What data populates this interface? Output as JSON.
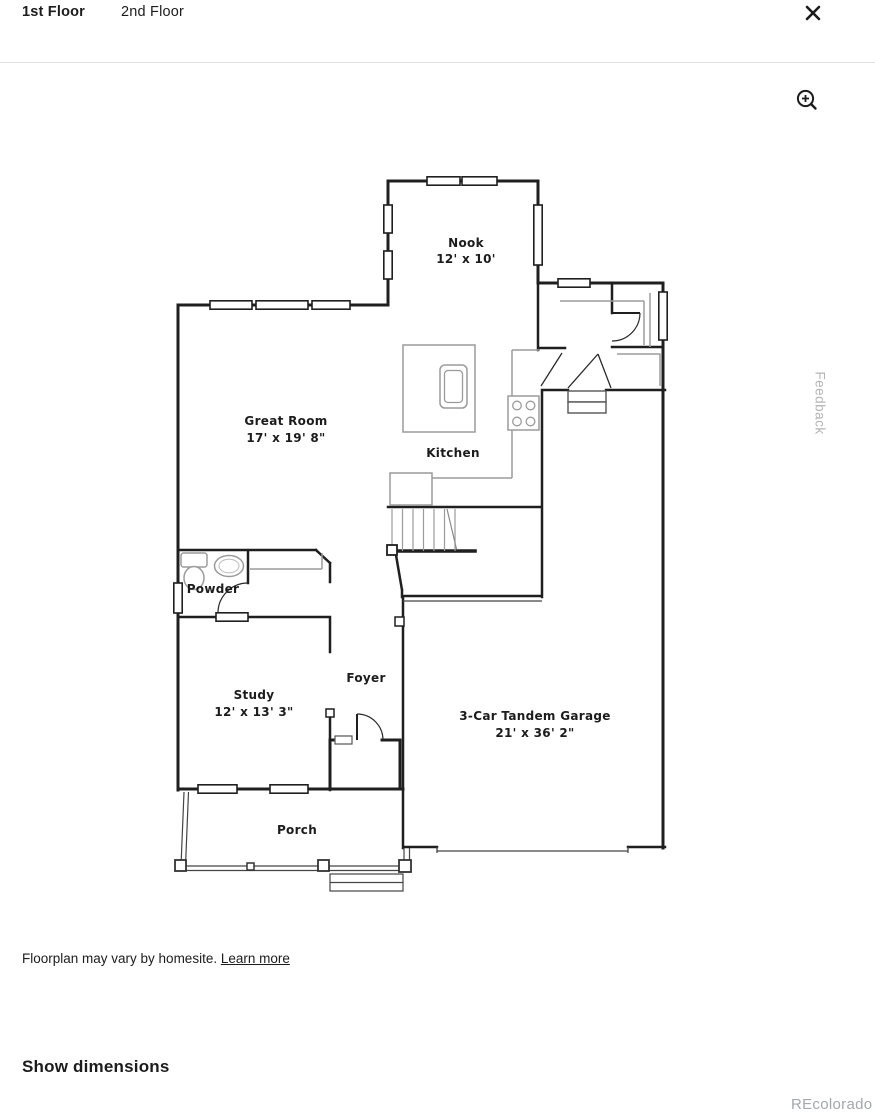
{
  "tabs": [
    {
      "label": "1st Floor",
      "active": true
    },
    {
      "label": "2nd Floor",
      "active": false
    }
  ],
  "controls": {
    "close_icon": "close",
    "zoom_in_icon": "magnifier-plus"
  },
  "floorplan": {
    "rooms": {
      "nook": {
        "name": "Nook",
        "dims": "12' x 10'"
      },
      "great_room": {
        "name": "Great Room",
        "dims": "17' x 19' 8\""
      },
      "kitchen": {
        "name": "Kitchen",
        "dims": ""
      },
      "powder": {
        "name": "Powder",
        "dims": ""
      },
      "study": {
        "name": "Study",
        "dims": "12' x 13' 3\""
      },
      "foyer": {
        "name": "Foyer",
        "dims": ""
      },
      "garage": {
        "name": "3-Car Tandem Garage",
        "dims": "21' x 36' 2\""
      },
      "porch": {
        "name": "Porch",
        "dims": ""
      }
    }
  },
  "feedback": {
    "label": "Feedback"
  },
  "footer": {
    "disclaimer": "Floorplan may vary by homesite. ",
    "learn_more_label": "Learn more",
    "show_dimensions_label": "Show dimensions",
    "watermark": "REcolorado"
  },
  "colors": {
    "wall": "#1f1f1f",
    "fixture": "#9b9b9b",
    "divider": "#e1e1e1",
    "muted_text": "#b4b4b4",
    "watermark_text": "#a3a8ab"
  }
}
